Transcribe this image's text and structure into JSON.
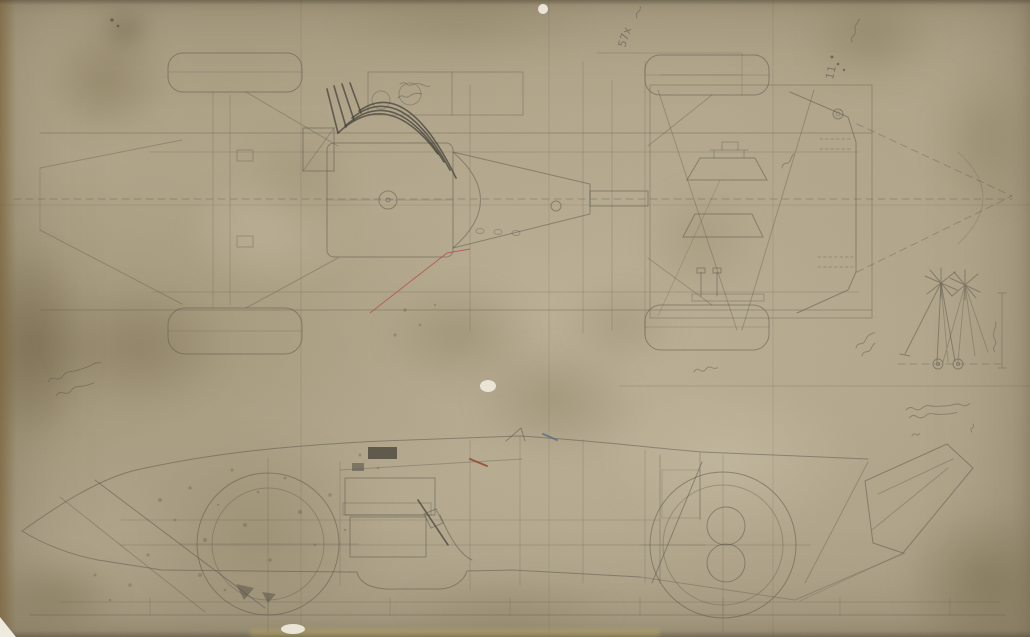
{
  "document": {
    "description": "Scanned pencil engineering drawing on aged stained tracing paper: racing car shown in plan view (top) and side elevation (bottom), with a suspension geometry detail at right",
    "media": "pencil on aged paper"
  },
  "palette": {
    "paper_light": "#c8bda4",
    "paper_mid": "#b4a98f",
    "paper_dark": "#9a8f76",
    "stain_brown": "#8a7c5c",
    "edge_brown": "#7c6b49",
    "pencil": "#5f5b4f",
    "pencil_dark": "#44413a",
    "ink_red": "#b5484e",
    "ink_red_brown": "#94462f",
    "ink_blue": "#5d7086",
    "spot_white": "#ece6d8"
  },
  "views": [
    {
      "id": "plan-view",
      "label": "plan view (chassis, engine, exhaust pipes, seats, boat-tail)"
    },
    {
      "id": "side-elevation",
      "label": "side elevation (nose, wheels, engine, tail fin)"
    },
    {
      "id": "suspension-geometry",
      "label": "suspension / steering geometry detail"
    }
  ],
  "annotations": [
    {
      "id": "note-57x",
      "text": "57x",
      "legible": true,
      "medium": "pencil",
      "rotation_deg": -72
    },
    {
      "id": "note-11",
      "text": "11",
      "legible": true,
      "medium": "pencil",
      "rotation_deg": -78
    },
    {
      "id": "note-top-right",
      "text": "",
      "legible": false
    },
    {
      "id": "note-left-margin",
      "text": "",
      "legible": false,
      "lines": 2
    },
    {
      "id": "note-suspension-left",
      "text": "",
      "legible": false
    },
    {
      "id": "note-suspension-dimension",
      "text": "",
      "legible": false
    },
    {
      "id": "note-signature-block",
      "text": "",
      "legible": false,
      "lines": 2
    },
    {
      "id": "note-rear-box",
      "text": "",
      "legible": false
    },
    {
      "id": "note-under-plan",
      "text": "",
      "legible": false
    }
  ],
  "colored_marks": {
    "red_diagonal_line": "#b5484e",
    "red_brown_dash": "#94462f",
    "blue_dash": "#5d7086"
  }
}
